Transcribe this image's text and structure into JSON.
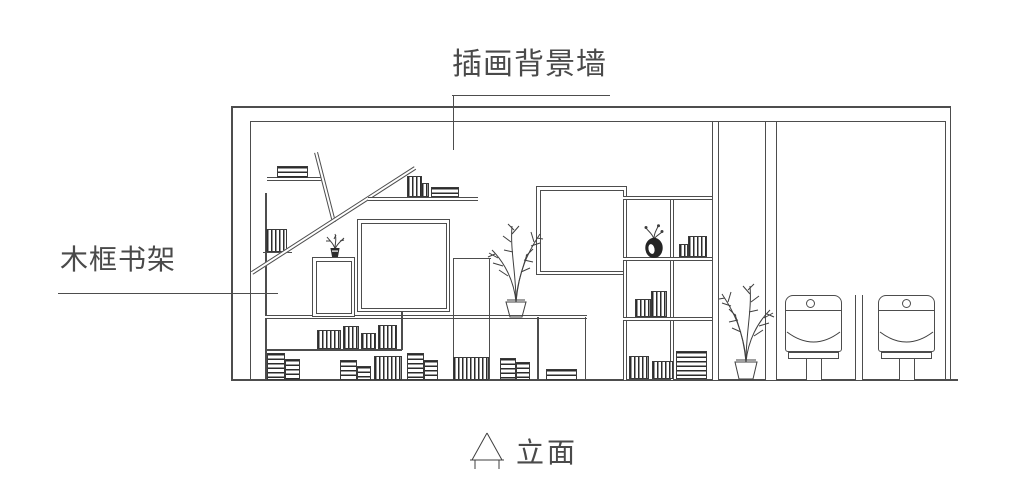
{
  "drawing": {
    "annotations": {
      "background_wall_label": "插画背景墙",
      "bookshelf_label": "木框书架",
      "view_label": "立面"
    },
    "colors": {
      "background": "#ffffff",
      "line": "#4d4d4d",
      "text": "#4a4a4a",
      "book_hatch": "#2c2c2c"
    },
    "icons": {
      "elevation-marker-icon": "triangle-on-baseline",
      "plant-icon": "potted-plant-outline",
      "small-plant-icon": "small-potted-plant",
      "vase-icon": "vase-with-flower-sprigs"
    }
  }
}
